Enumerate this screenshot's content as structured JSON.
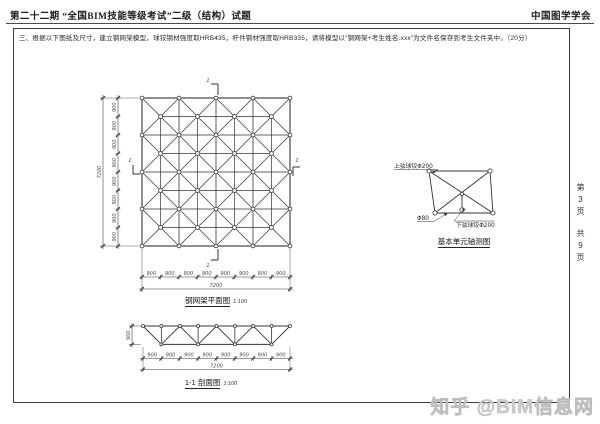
{
  "header": {
    "title": "第二十二期 “全国BIM技能等级考试”二级（结构）试题",
    "organization": "中国图学学会"
  },
  "instruction": "三、根据以下图纸及尺寸，建立钢网架模型，球铰钢材强度取HRB435，杆件钢材强度取HRB335，请将模型以“钢网架+考生姓名.xxx”为文件名保存到考生文件夹中。（20分）",
  "plan_view": {
    "title": "钢网架平面图",
    "scale": "1:100",
    "section_mark": "1",
    "horizontal_segments": [
      "900",
      "900",
      "900",
      "900",
      "900",
      "900",
      "900",
      "900"
    ],
    "vertical_segments": [
      "900",
      "900",
      "900",
      "900",
      "900",
      "900",
      "900",
      "900"
    ],
    "total_width": "7200",
    "total_height": "7200"
  },
  "section_view": {
    "title": "1-1 剖面图",
    "scale": "1:100",
    "height_label": "900",
    "segments": [
      "900",
      "900",
      "900",
      "900",
      "900",
      "900",
      "900",
      "900"
    ],
    "total": "7200"
  },
  "detail_view": {
    "title": "基本单元轴测图",
    "upper_ball_label": "上弦球铰Φ200",
    "member_label": "Φ80",
    "lower_ball_label": "下弦球铰Φ200"
  },
  "sidebar": {
    "page_chars": [
      "第",
      "3",
      "页"
    ],
    "total_chars": [
      "共",
      "9",
      "页"
    ]
  },
  "watermark": "知乎 @BIM信息网",
  "colors": {
    "ink": "#333333",
    "dim": "#4a4a4a",
    "watermark": "#cdcdcd"
  }
}
